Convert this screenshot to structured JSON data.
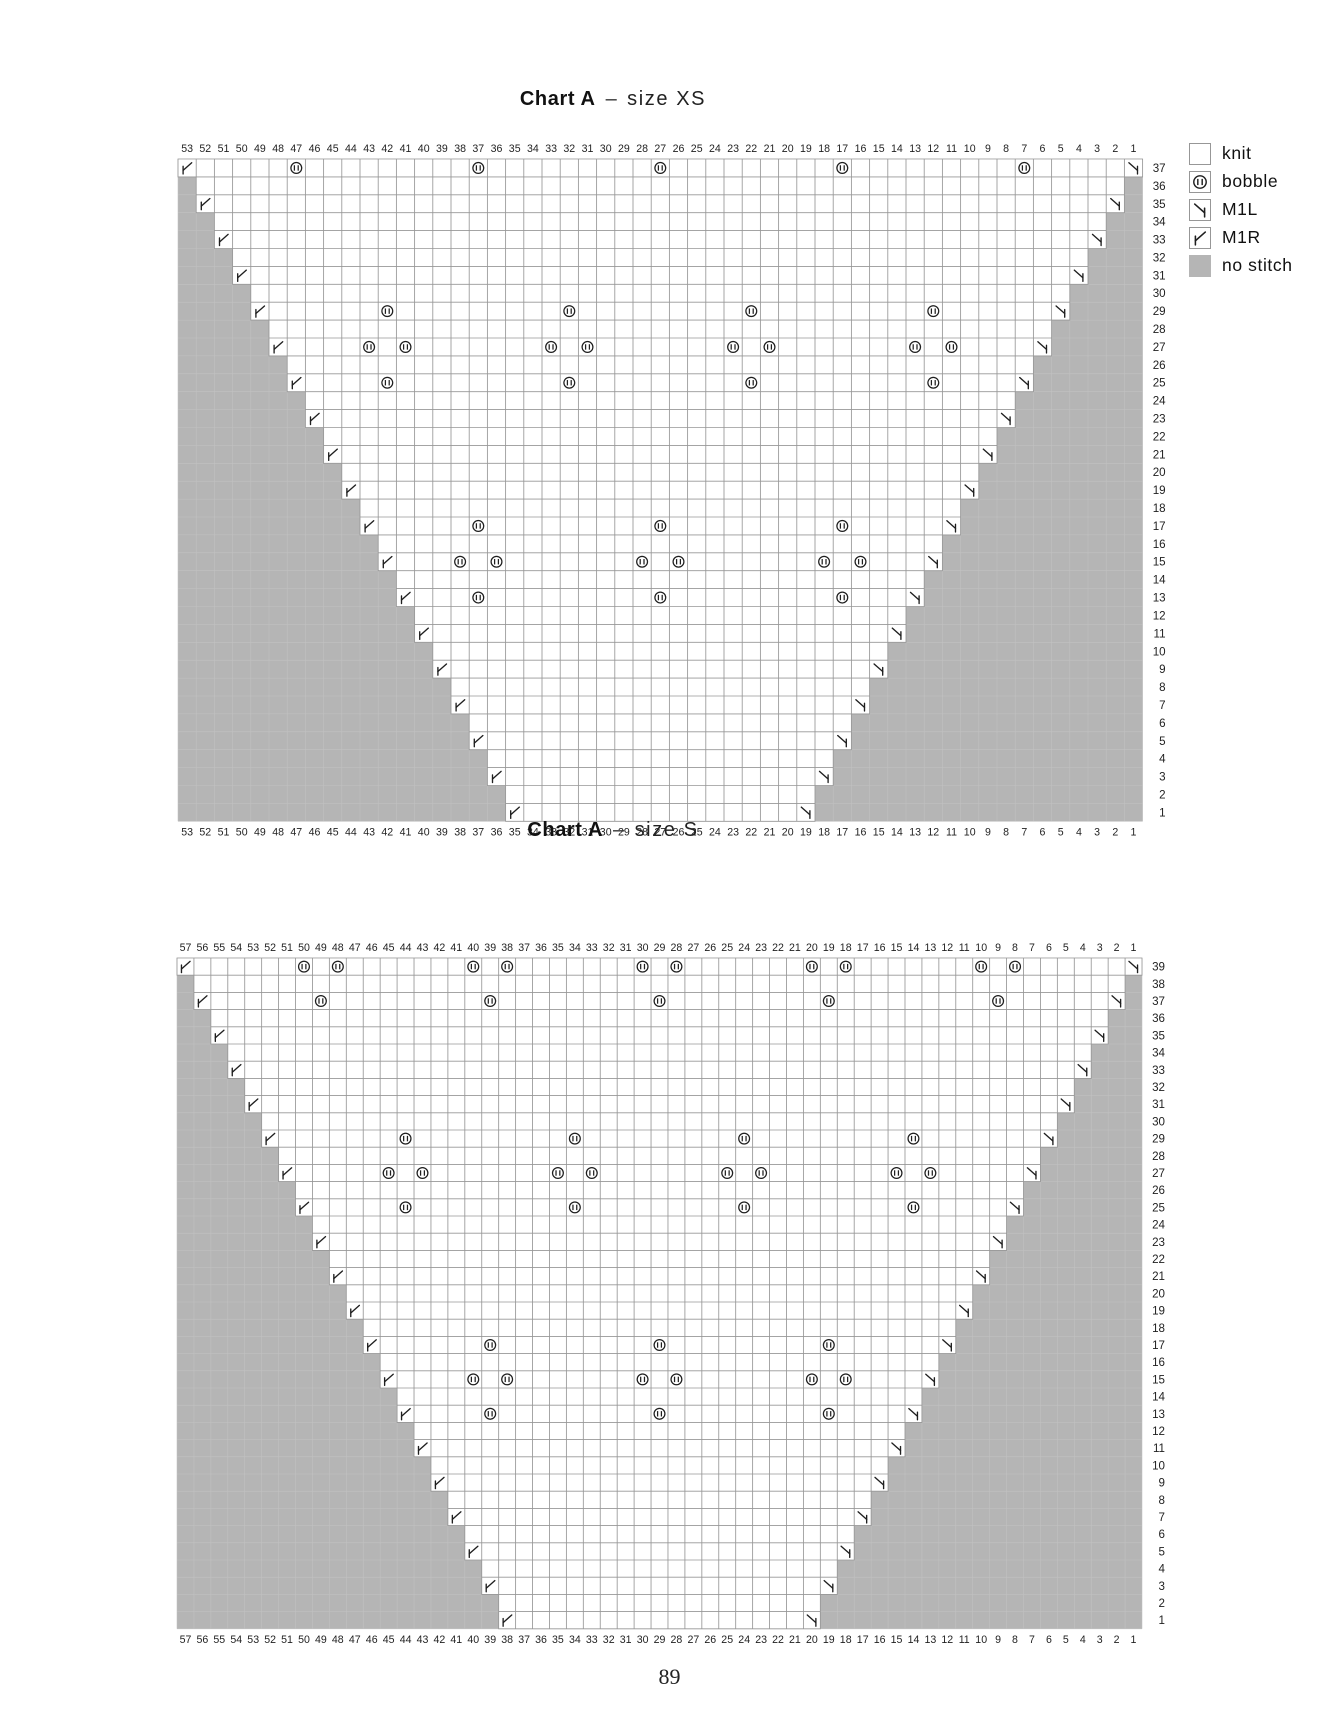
{
  "page": {
    "number": "89"
  },
  "colors": {
    "no_stitch": "#b5b5b5",
    "cell_border": "#979797",
    "faint_grid": "#c2c2c2",
    "symbol": "#1f1f1f",
    "knit_fill": "#ffffff"
  },
  "legend": {
    "items": [
      {
        "symbol": "knit",
        "label": "knit"
      },
      {
        "symbol": "bobble",
        "label": "bobble"
      },
      {
        "symbol": "m1l",
        "label": "M1L"
      },
      {
        "symbol": "m1r",
        "label": "M1R"
      },
      {
        "symbol": "no-stitch",
        "label": "no stitch"
      }
    ]
  },
  "chart_data": [
    {
      "type": "heatmap",
      "subtype": "knitting symbol chart (triangular shawl body)",
      "title": {
        "name": "Chart A",
        "dash": "–",
        "size": "size XS"
      },
      "columns": 53,
      "rows": 37,
      "column_labels": "53 down to 1, shown above and below the grid",
      "row_labels": "37 down to 1, shown right of the grid",
      "row1_white": {
        "left_col": 35,
        "right_col": 19
      },
      "shape_rule": "white span widens by one column on each side every 2 rows going up; all other cells are no-stitch gray",
      "increases": {
        "m1r": "leftmost white cell of every odd row",
        "m1l": "rightmost white cell of every odd row"
      },
      "bobbles": [
        {
          "row": 37,
          "cols": [
            47,
            37,
            27,
            17,
            7
          ]
        },
        {
          "row": 29,
          "cols": [
            42,
            32,
            22,
            12
          ]
        },
        {
          "row": 27,
          "cols": [
            43,
            41,
            33,
            31,
            23,
            21,
            13,
            11
          ]
        },
        {
          "row": 25,
          "cols": [
            42,
            32,
            22,
            12
          ]
        },
        {
          "row": 17,
          "cols": [
            37,
            27,
            17
          ]
        },
        {
          "row": 15,
          "cols": [
            38,
            36,
            28,
            26,
            18,
            16
          ]
        },
        {
          "row": 13,
          "cols": [
            37,
            27,
            17
          ]
        }
      ]
    },
    {
      "type": "heatmap",
      "subtype": "knitting symbol chart (triangular shawl body)",
      "title": {
        "name": "Chart A",
        "dash": "–",
        "size": "size S"
      },
      "columns": 57,
      "rows": 39,
      "column_labels": "57 down to 1, shown above and below the grid",
      "row_labels": "39 down to 1, shown right of the grid",
      "row1_white": {
        "left_col": 38,
        "right_col": 20
      },
      "shape_rule": "white span widens by one column on each side every 2 rows going up; all other cells are no-stitch gray",
      "increases": {
        "m1r": "leftmost white cell of every odd row",
        "m1l": "rightmost white cell of every odd row"
      },
      "bobbles": [
        {
          "row": 39,
          "cols": [
            50,
            48,
            40,
            38,
            30,
            28,
            20,
            18,
            10,
            8
          ]
        },
        {
          "row": 37,
          "cols": [
            49,
            39,
            29,
            19,
            9
          ]
        },
        {
          "row": 29,
          "cols": [
            44,
            34,
            24,
            14
          ]
        },
        {
          "row": 27,
          "cols": [
            45,
            43,
            35,
            33,
            25,
            23,
            15,
            13
          ]
        },
        {
          "row": 25,
          "cols": [
            44,
            34,
            24,
            14
          ]
        },
        {
          "row": 17,
          "cols": [
            39,
            29,
            19
          ]
        },
        {
          "row": 15,
          "cols": [
            40,
            38,
            30,
            28,
            20,
            18
          ]
        },
        {
          "row": 13,
          "cols": [
            39,
            29,
            19
          ]
        }
      ]
    }
  ]
}
